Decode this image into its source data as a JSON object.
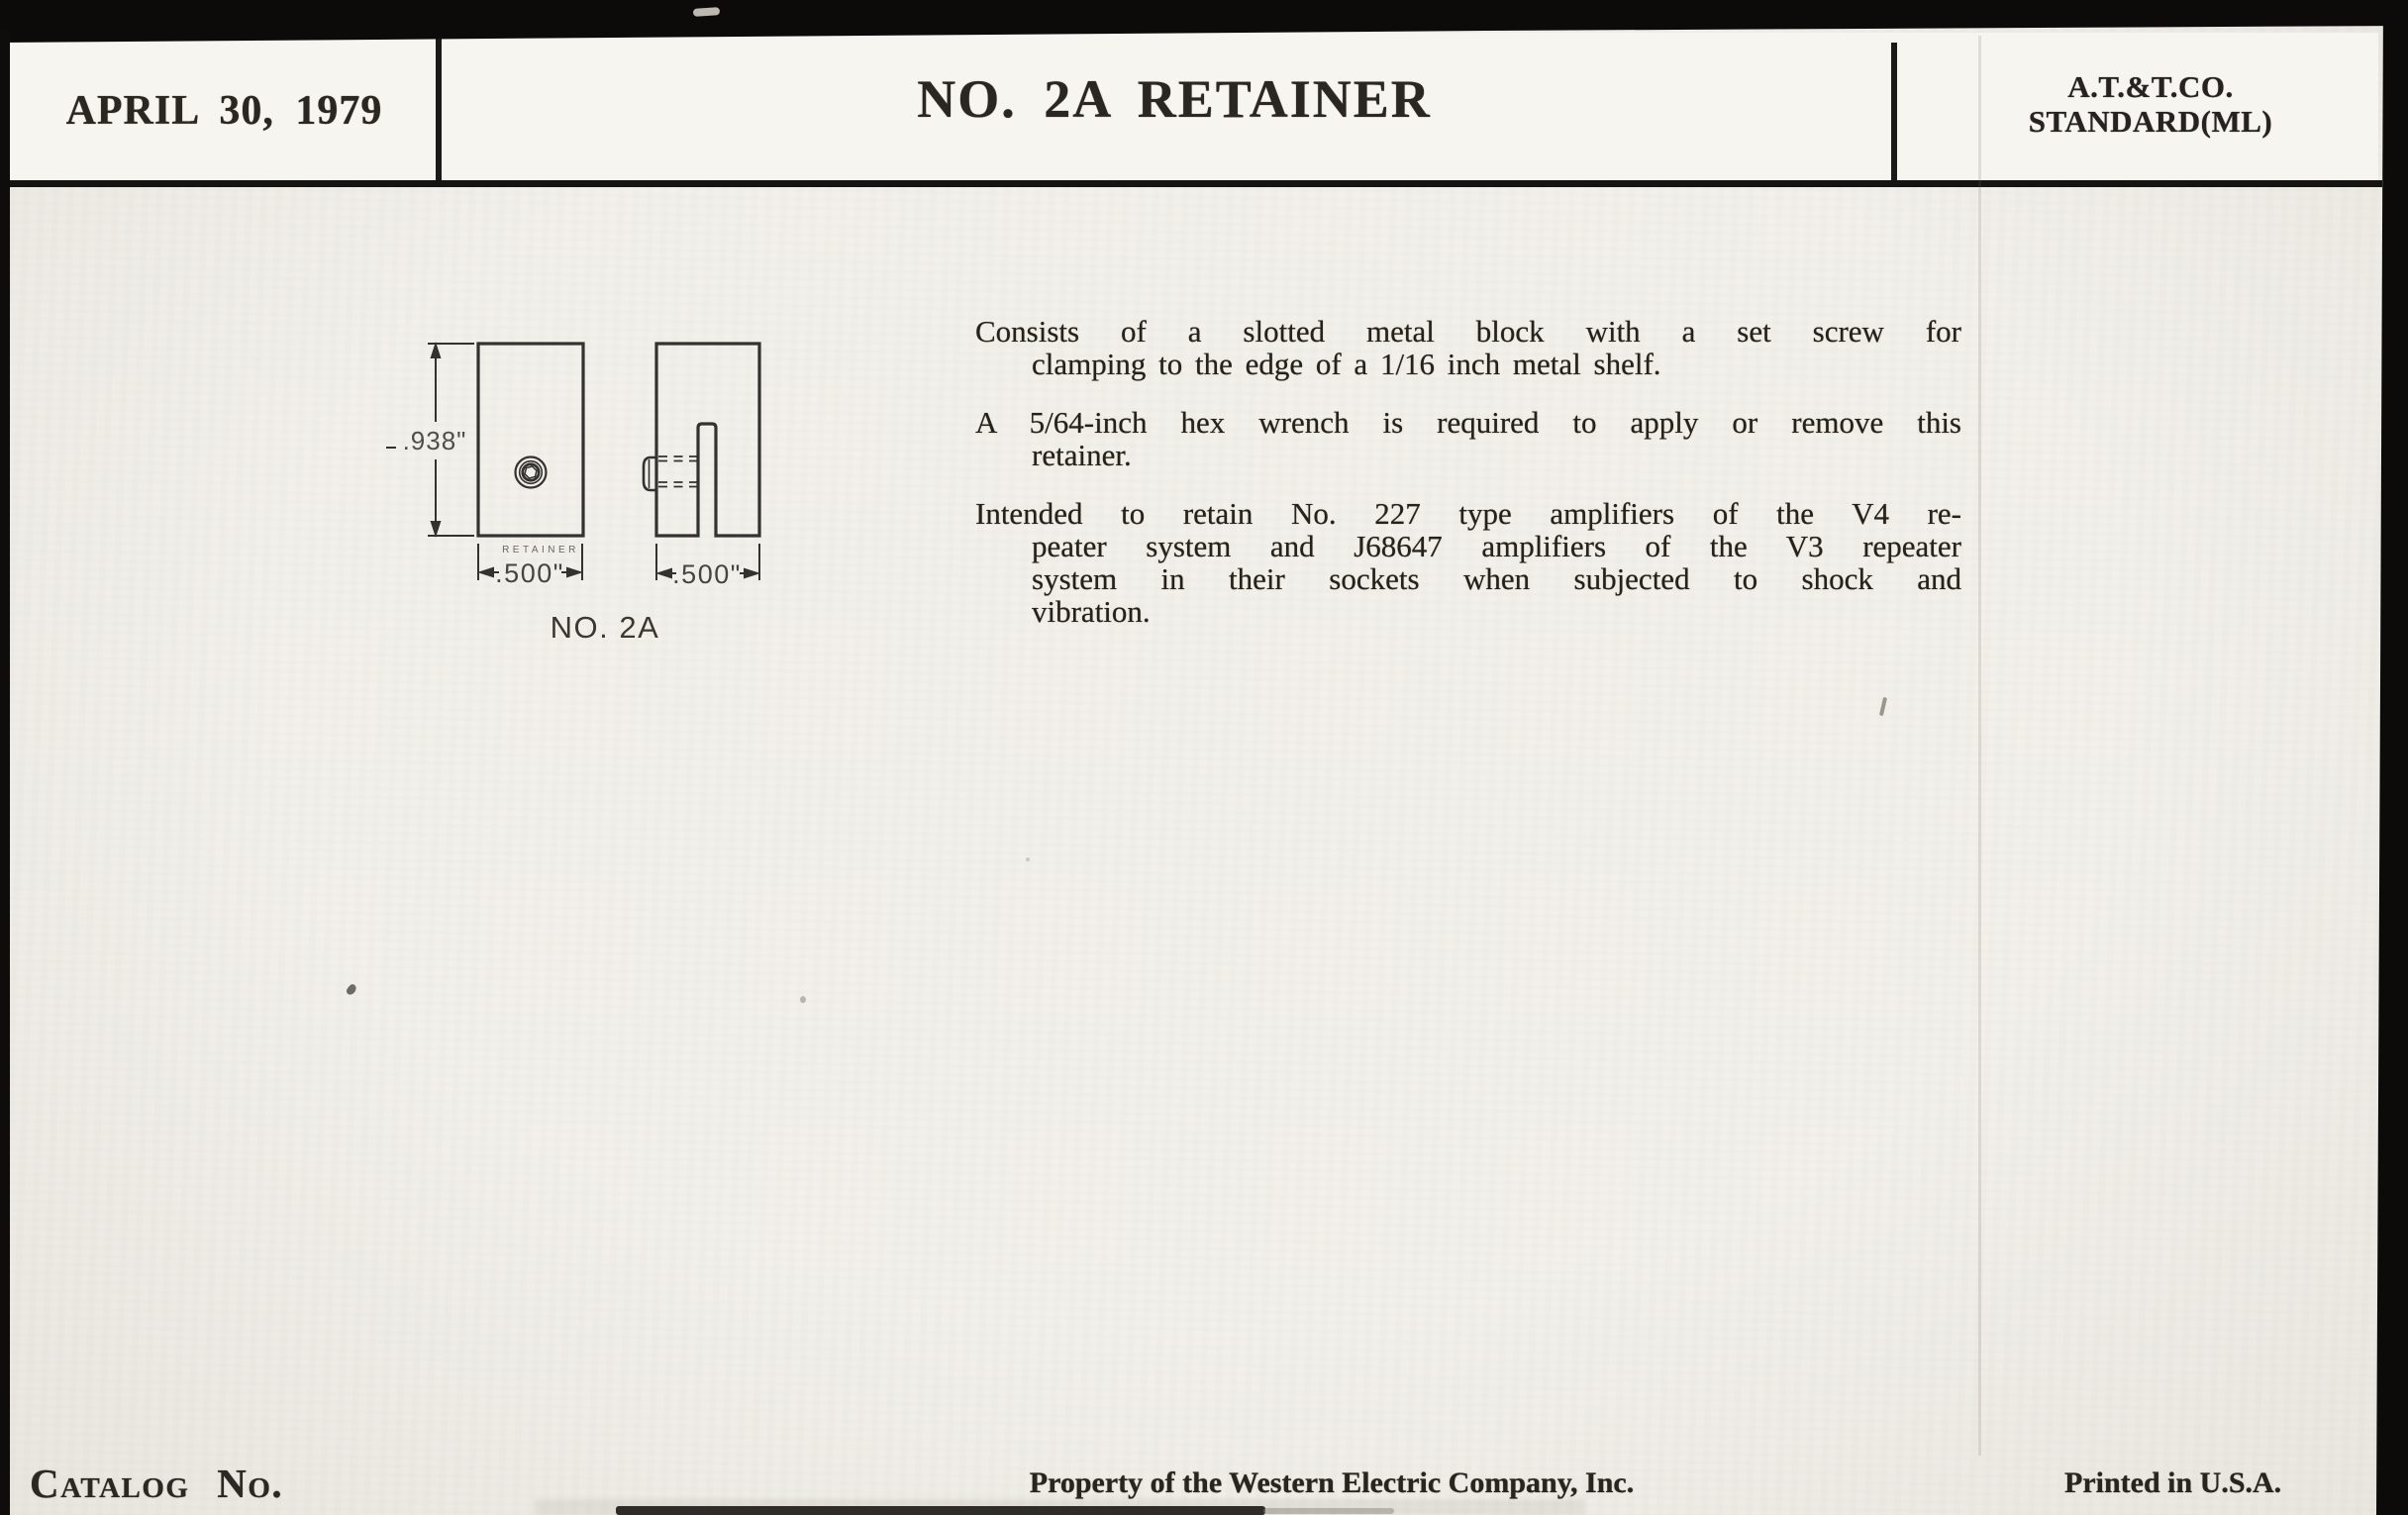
{
  "colors": {
    "paper": "#f1efe9",
    "ink": "#26231e",
    "scan_border": "#0c0b0a"
  },
  "header": {
    "date": "APRIL 30, 1979",
    "title": "NO. 2A RETAINER",
    "standard": [
      "A.T.&T.CO.",
      "STANDARD(ML)"
    ]
  },
  "figure": {
    "front_view": {
      "height_dim": ".938\"",
      "width_dim": ".500\"",
      "stamp": "RETAINER"
    },
    "side_view": {
      "width_dim": ".500\""
    },
    "caption": "NO. 2A"
  },
  "body": {
    "paragraphs": [
      {
        "lines": [
          "Consists of a slotted metal block with a set screw for",
          "clamping to the edge of a 1/16 inch metal shelf."
        ]
      },
      {
        "lines": [
          "A 5/64-inch hex wrench is required to apply or remove this",
          "retainer."
        ]
      },
      {
        "lines": [
          "Intended to retain No. 227 type amplifiers of the V4 re-",
          "peater system and J68647 amplifiers of the V3 repeater",
          "system in their sockets when subjected to shock and",
          "vibration."
        ]
      }
    ]
  },
  "footer": {
    "catalog_label": "Catalog No.",
    "property": "Property of the Western Electric Company, Inc.",
    "printed": "Printed in U.S.A."
  }
}
